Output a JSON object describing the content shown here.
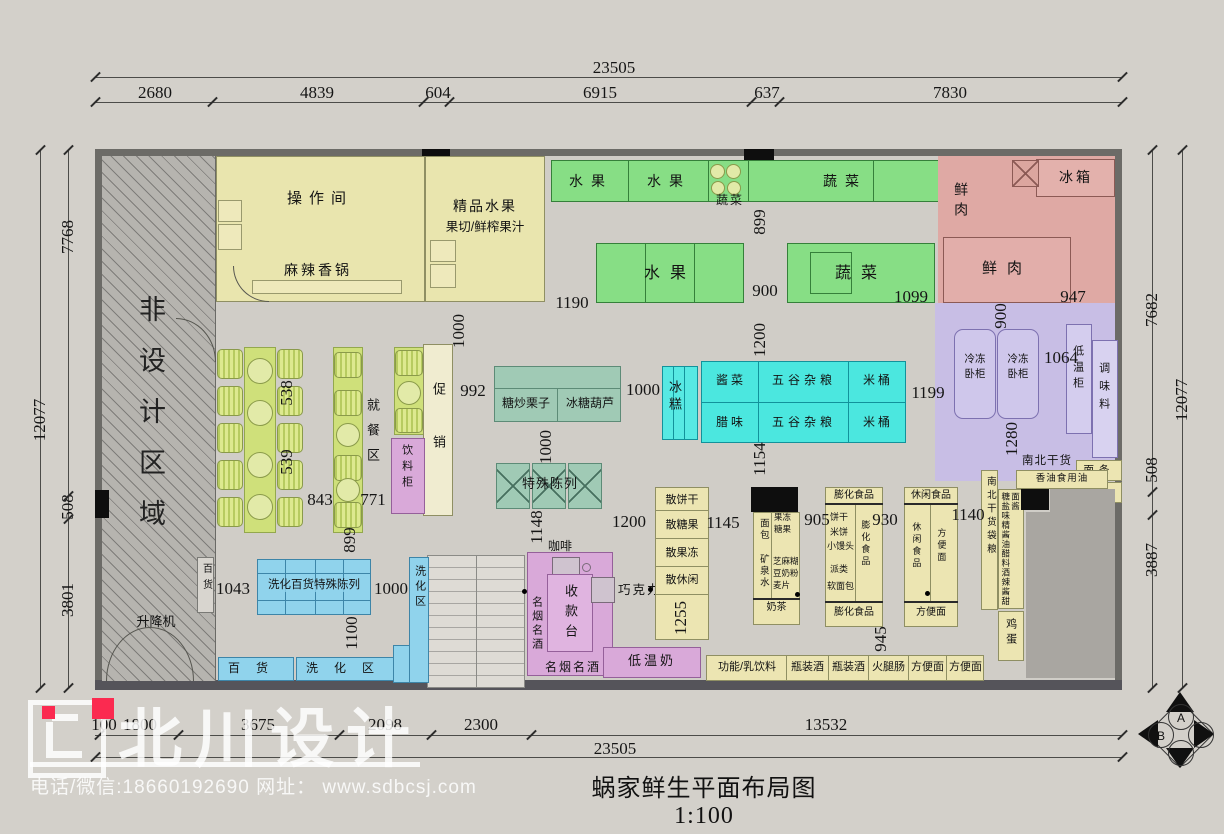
{
  "title": "蜗家鲜生平面布局图1:100",
  "watermark": {
    "brand": "北川设计",
    "contact": "电话/微信:18660192690 网址： www.sdbcsj.com"
  },
  "compass": {
    "top": "A",
    "left": "B",
    "bottom": "C",
    "right": "D"
  },
  "dims": {
    "top_total": "23505",
    "bottom_total": "23505",
    "top": [
      "2680",
      "4839",
      "604",
      "6915",
      "637",
      "7830"
    ],
    "bottom": [
      "100",
      "1800",
      "3675",
      "2098",
      "2300",
      "13532"
    ],
    "left": [
      "7768",
      "508",
      "3801"
    ],
    "left_total": "12077",
    "right": [
      "7682",
      "508",
      "3887"
    ],
    "right_total": "12077",
    "inner": {
      "n1190": "1190",
      "v1000_entry": "1000",
      "v899_top": "899",
      "n900": "900",
      "n1099": "1099",
      "n947": "947",
      "v900_meat": "900",
      "n992": "992",
      "n1000_mid": "1000",
      "v1000_chestnut": "1000",
      "v1200_grain": "1200",
      "n1199": "1199",
      "n1064": "1064",
      "v1280": "1280",
      "v1154": "1154",
      "n1140": "1140",
      "v1148": "1148",
      "n1200_bulk": "1200",
      "n1145": "1145",
      "n905": "905",
      "n930": "930",
      "v1255": "1255",
      "n1043": "1043",
      "n1000_wash": "1000",
      "v899_wash": "899",
      "v1100": "1100",
      "v538": "538",
      "v539": "539",
      "n843": "843",
      "n771": "771",
      "v945": "945"
    }
  },
  "labels": {
    "non_design": "非设计区域",
    "lift": "升降机",
    "dept": "百货",
    "op_room": "操作间",
    "mala": "麻辣香锅",
    "premium_fruit": "精品水果",
    "juice": "果切/鲜榨果汁",
    "fruit": "水果",
    "veg": "蔬菜",
    "fridge": "冰箱",
    "meat": "鲜肉",
    "dining": "就餐区",
    "promo": "促销",
    "drink_cab": "饮料柜",
    "chestnut": "糖炒栗子",
    "haw": "冰糖葫芦",
    "ice": "冰糕",
    "pickle": "酱菜",
    "grain": "五谷杂粮",
    "rice_bucket": "米桶",
    "cured": "腊味",
    "freezer": "冷冻卧柜",
    "lowtemp": "低温柜",
    "seasoning": "调味料",
    "noodle": "面条",
    "flour": "面食",
    "drygoods": "南北干货",
    "oil": "香油食用油",
    "drygoods_bag": "南北干货袋粮",
    "condiments": "糖盐味精酱油醋料酒辣酱甜面酱",
    "egg": "鸡蛋",
    "special": "特殊陈列",
    "wash_special": "洗化百货特殊陈列",
    "wash_zone": "洗化区",
    "coffee": "咖啡",
    "cashier": "收款台",
    "tobacco": "名烟名酒",
    "chocolate": "巧克力",
    "milk": "低温奶",
    "bulk_biscuit": "散饼干",
    "bulk_candy": "散糖果",
    "bulk_jelly": "散果冻",
    "bulk_leisure": "散休闲",
    "bread": "面包",
    "water": "矿泉水",
    "milktea": "奶茶",
    "jelly": "果冻",
    "candy": "糖果",
    "sesame": "芝麻糊",
    "soymilk": "豆奶粉",
    "oat": "麦片",
    "puffed": "膨化食品",
    "biscuit": "饼干",
    "ricecake": "米饼",
    "bun": "小馒头",
    "pie": "派类",
    "softbread": "软面包",
    "leisure": "休闲食品",
    "inst_noodle": "方便面",
    "func_milk": "功能/乳饮料",
    "wine": "瓶装酒",
    "ham": "火腿肠"
  }
}
